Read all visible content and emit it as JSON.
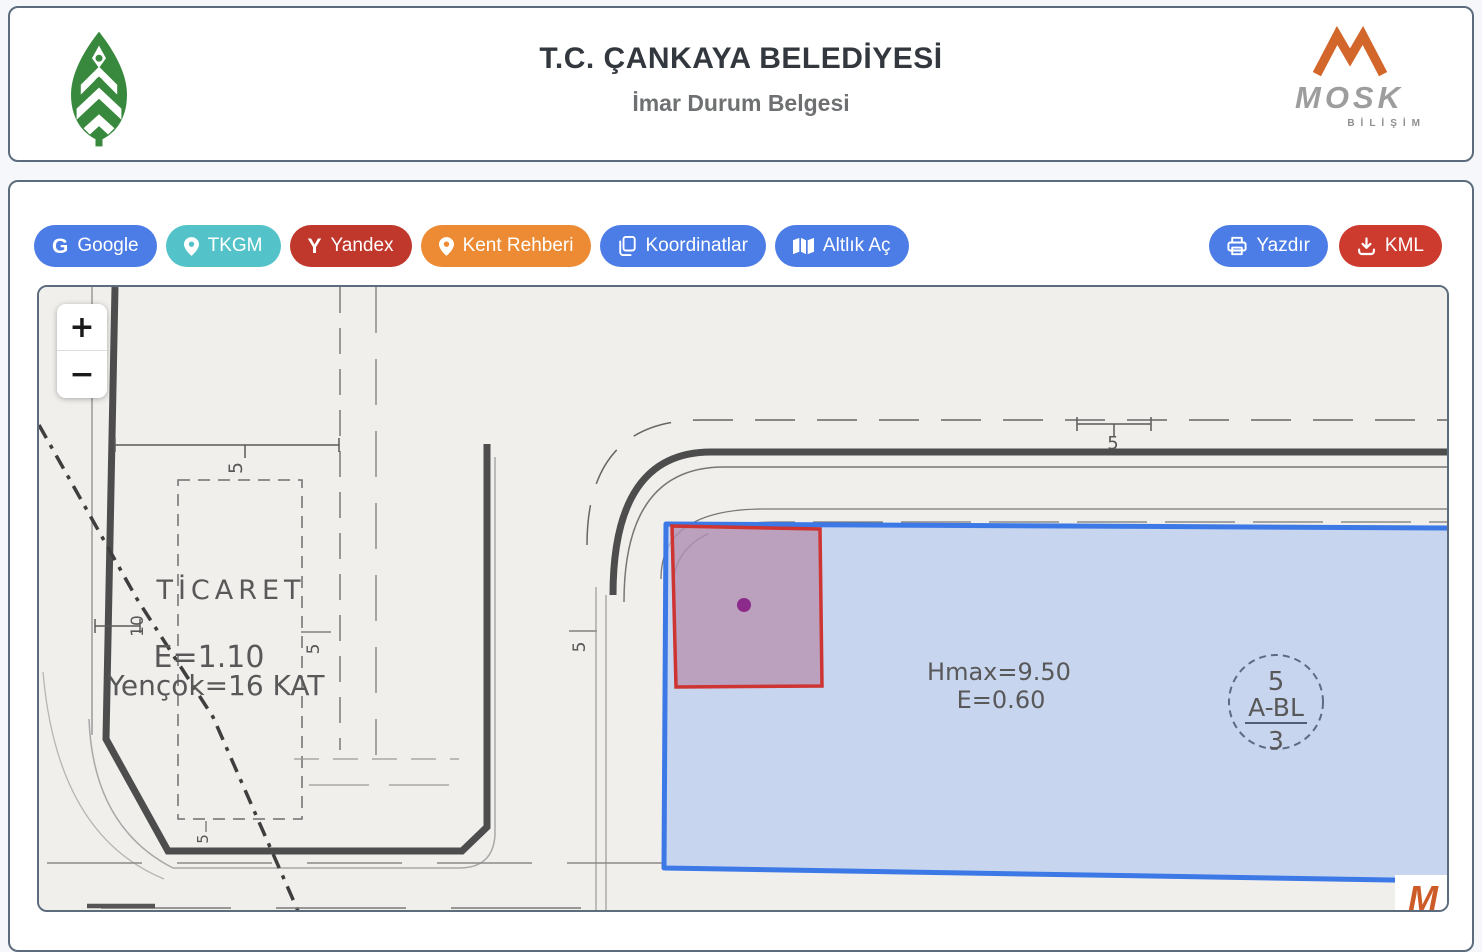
{
  "header": {
    "title": "T.C. ÇANKAYA BELEDİYESİ",
    "subtitle": "İmar Durum Belgesi",
    "mosk": {
      "name": "MOSK",
      "tagline": "BİLİŞİM"
    }
  },
  "toolbar": {
    "left_buttons": [
      {
        "label": "Google",
        "icon": "google-icon",
        "color": "#4c7ce5"
      },
      {
        "label": "TKGM",
        "icon": "map-pin-icon",
        "color": "#54c3c9"
      },
      {
        "label": "Yandex",
        "icon": "yandex-icon",
        "color": "#bf382b"
      },
      {
        "label": "Kent Rehberi",
        "icon": "map-pin-icon",
        "color": "#ec8b33"
      },
      {
        "label": "Koordinatlar",
        "icon": "copy-icon",
        "color": "#4c7ce5"
      },
      {
        "label": "Altlık Aç",
        "icon": "map-icon",
        "color": "#4c7ce5"
      }
    ],
    "right_buttons": [
      {
        "label": "Yazdır",
        "icon": "printer-icon",
        "color": "#4c7ce5"
      },
      {
        "label": "KML",
        "icon": "download-icon",
        "color": "#cc3b2e"
      }
    ]
  },
  "map": {
    "zoom_in": "+",
    "zoom_out": "−",
    "zone_left": {
      "name": "TİCARET",
      "line1": "E=1.10",
      "line2": "Yençok=16 KAT"
    },
    "zone_right": {
      "line1": "Hmax=9.50",
      "line2": "E=0.60"
    },
    "block_label": {
      "top": "5",
      "middle": "A-BL",
      "bottom": "3"
    },
    "dimensions": {
      "five": "5",
      "ten": "10"
    },
    "watermark": "M"
  },
  "colors": {
    "panel_border": "#5c6c7c",
    "button_blue": "#4c7ce5",
    "button_teal": "#54c3c9",
    "button_dark_red": "#bf382b",
    "button_orange": "#ec8b33",
    "button_kml_red": "#cc3b2e",
    "map_background": "#f0efec",
    "parcel_blue_fill": "#b7cbf0",
    "parcel_blue_stroke": "#3c78e6",
    "parcel_red_stroke": "#ce3431",
    "selected_point_purple": "#8d2b8d",
    "logo_green": "#38893d",
    "mosk_orange": "#d2662b"
  }
}
